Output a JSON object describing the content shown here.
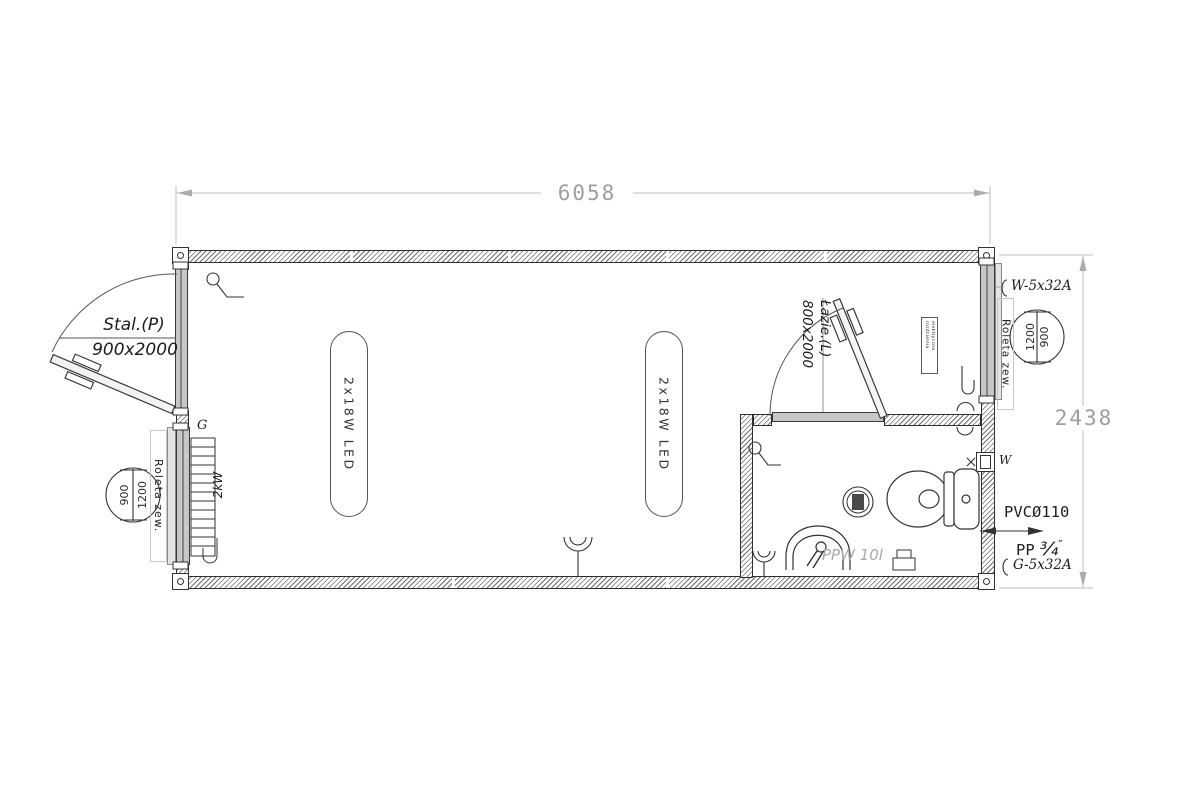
{
  "dimensions": {
    "width": "6058",
    "height": "2438"
  },
  "entry_door": {
    "label": "Stal.(P)",
    "size": "900x2000"
  },
  "bathroom_door": {
    "label": "Łazie.(L)",
    "size": "800x2000"
  },
  "left_window": {
    "shutter": "Roleta zew.",
    "dim_inner": "1200",
    "dim_outer": "900"
  },
  "right_window": {
    "shutter": "Roleta zew.",
    "dim_inner": "1200",
    "dim_outer": "900"
  },
  "heating": {
    "radiator_power": "2kW",
    "circuit_mark": "G"
  },
  "lighting": {
    "fixture_1": "2x18W LED",
    "fixture_2": "2x18W LED"
  },
  "electrical": {
    "power_inlet": "W-5x32A",
    "socket_circuit": "G-5x32A",
    "panel_label_line1": "rozdzielnia",
    "panel_label_line2": "elektryczna"
  },
  "plumbing": {
    "sewage_pipe": "PVCØ110",
    "water_pipe": "PP",
    "water_pipe_fraction": "¾",
    "water_pipe_unit": "″",
    "water_heater": "PPW 10l",
    "water_mark": "W"
  },
  "colors": {
    "line": "#3a3a3a",
    "dimension": "#9e9e9e",
    "frame_grey": "#c7c7c7"
  }
}
